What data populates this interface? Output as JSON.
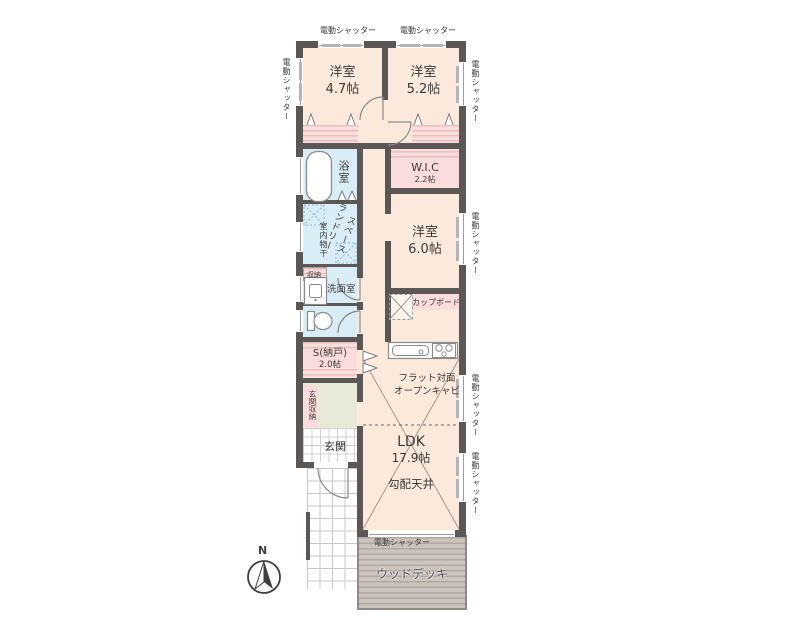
{
  "labels": {
    "shutter": "電動シャッター",
    "compass_n": "N"
  },
  "rooms": {
    "bedroom47": {
      "name": "洋室",
      "size": "4.7帖"
    },
    "bedroom52": {
      "name": "洋室",
      "size": "5.2帖"
    },
    "bedroom60": {
      "name": "洋室",
      "size": "6.0帖"
    },
    "wic": {
      "name": "W.I.C",
      "size": "2.2帖"
    },
    "bath": {
      "name": "浴室"
    },
    "laundry": {
      "lines": [
        "ランドリー",
        "スペース"
      ]
    },
    "indoor_drying": {
      "name": "室内物干"
    },
    "closet_small": {
      "name": "収納"
    },
    "washroom": {
      "name": "洗面室"
    },
    "storage_s": {
      "name": "S(納戸)",
      "size": "2.0帖"
    },
    "cupboard": {
      "name": "カップボード"
    },
    "kitchen_cabinet": {
      "lines": [
        "フラット対面",
        "オープンキャビ"
      ]
    },
    "ldk": {
      "name": "LDK",
      "size": "17.9帖"
    },
    "sloped_ceiling": {
      "name": "勾配天井"
    },
    "entrance": {
      "name": "玄関"
    },
    "entrance_storage": {
      "name": "玄関収納"
    },
    "wood_deck": {
      "name": "ウッドデッキ"
    }
  },
  "colors": {
    "wall": "#5b5754",
    "room_cream": "#fbeadc",
    "closet_pink": "#f9dcdb",
    "wet_blue": "#d9edf6",
    "hall_green": "#e9e9da",
    "deck_gray": "#cdc3bd"
  }
}
